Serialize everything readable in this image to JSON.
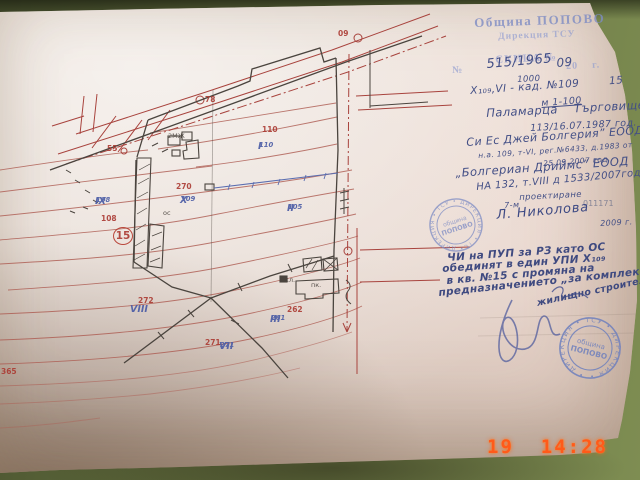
{
  "camera_timestamp": "19  14:28",
  "document": {
    "round_stamp": {
      "center_line1": "община",
      "center_line2": "ПОПОВО",
      "ring_text": "• ДИРЕКЦИЯ • ТСУ • ДИРЕКЦИЯ • ТСУ"
    }
  },
  "hw": {
    "lines": [
      {
        "n": "office-stamp-line1",
        "t": "Община ПОПОВО",
        "x": 474,
        "y": 16,
        "s": 13,
        "r": -2,
        "c": "stamp"
      },
      {
        "n": "office-stamp-line2",
        "t": "Дирекция ТСУ",
        "x": 498,
        "y": 33,
        "s": 9.5,
        "r": -2,
        "c": "stamp2"
      },
      {
        "n": "sketch-title",
        "t": "СКИЦА №",
        "x": 495,
        "y": 55,
        "s": 11,
        "r": -2.5,
        "c": "stamp2"
      },
      {
        "n": "form-number-sign",
        "t": "№",
        "x": 452,
        "y": 66,
        "s": 10,
        "r": -2.5,
        "c": "stamp2"
      },
      {
        "n": "form-year",
        "t": "20    г.",
        "x": 566,
        "y": 62,
        "s": 10,
        "r": -2.5,
        "c": "stamp2"
      },
      {
        "n": "sketch-number",
        "t": "515/1965",
        "x": 486,
        "y": 58,
        "s": 13,
        "r": -5,
        "c": "ink"
      },
      {
        "n": "sketch-year",
        "t": "09",
        "x": 556,
        "y": 57,
        "s": 12,
        "r": -5,
        "c": "ink"
      },
      {
        "n": "area-value",
        "t": "1000",
        "x": 517,
        "y": 76,
        "s": 8.5,
        "r": -3,
        "c": "ink"
      },
      {
        "n": "parcel-line",
        "t": "Х₁₀₉,VI - кад. №109        15",
        "x": 470,
        "y": 86,
        "s": 10.5,
        "r": -4,
        "c": "ink"
      },
      {
        "n": "scale-note",
        "t": "м 1-100",
        "x": 541,
        "y": 99,
        "s": 9.5,
        "r": -4,
        "c": "ink underl"
      },
      {
        "n": "place-line",
        "t": "Паламарца    Търговище",
        "x": 486,
        "y": 108,
        "s": 11.5,
        "r": -3,
        "c": "ink"
      },
      {
        "n": "ref-number",
        "t": "113/16.07.1987 год.",
        "x": 530,
        "y": 124,
        "s": 9.5,
        "r": -3,
        "c": "ink"
      },
      {
        "n": "owner1",
        "t": "Си Ес Джей Болгерия” ЕООД",
        "x": 466,
        "y": 137,
        "s": 11,
        "r": -4,
        "c": "ink"
      },
      {
        "n": "deed1",
        "t": "н.а. 109, т-VI, рег.№6433, д.1983 от",
        "x": 478,
        "y": 152,
        "s": 7.5,
        "r": -4,
        "c": "ink"
      },
      {
        "n": "deed1-date",
        "t": "25.09.2007 год.",
        "x": 543,
        "y": 160,
        "s": 7.5,
        "r": -4,
        "c": "ink"
      },
      {
        "n": "owner2",
        "t": "„Болгериан Дриймс” ЕООД",
        "x": 455,
        "y": 168,
        "s": 11.5,
        "r": -4,
        "c": "ink"
      },
      {
        "n": "deed2",
        "t": "НА 132, т.VIII д 1533/2007год.",
        "x": 476,
        "y": 183,
        "s": 10,
        "r": -5,
        "c": "ink"
      },
      {
        "n": "purpose",
        "t": "проектиране",
        "x": 519,
        "y": 194,
        "s": 8.5,
        "r": -3,
        "c": "ink"
      },
      {
        "n": "sig-prefix",
        "t": "7-м",
        "x": 504,
        "y": 202,
        "s": 8,
        "r": -3,
        "c": "ink"
      },
      {
        "n": "code-number",
        "t": "011171",
        "x": 583,
        "y": 200,
        "s": 8,
        "r": 0,
        "c": "inkfaint"
      },
      {
        "n": "officer-name",
        "t": "Л. Николова",
        "x": 496,
        "y": 209,
        "s": 13,
        "r": -5,
        "c": "inksig"
      },
      {
        "n": "year2",
        "t": "2009 г.",
        "x": 600,
        "y": 220,
        "s": 8,
        "r": -3,
        "c": "ink"
      },
      {
        "n": "note-line1",
        "t": "ЧИ на ПУП за РЗ като ОС",
        "x": 447,
        "y": 253,
        "s": 10.5,
        "r": -4,
        "c": "note"
      },
      {
        "n": "note-line2",
        "t": "обединят в един УПИ Х₁₀₉",
        "x": 442,
        "y": 264,
        "s": 10.5,
        "r": -4,
        "c": "note"
      },
      {
        "n": "note-line3",
        "t": "в кв. №15 с промяна на",
        "x": 446,
        "y": 276,
        "s": 10.5,
        "r": -5,
        "c": "note"
      },
      {
        "n": "note-line4",
        "t": "предназначението „за комплексно",
        "x": 438,
        "y": 288,
        "s": 10.5,
        "r": -6,
        "c": "note"
      },
      {
        "n": "note-line5",
        "t": "жилищно строителство”",
        "x": 536,
        "y": 299,
        "s": 9.5,
        "r": -12,
        "c": "note"
      }
    ]
  },
  "map": {
    "parcel_labels": [
      {
        "roman": "IX",
        "num": "108",
        "x": 95,
        "y": 197
      },
      {
        "roman": "X",
        "num": "109",
        "x": 180,
        "y": 196
      },
      {
        "roman": "I",
        "num": "110",
        "x": 258,
        "y": 142
      },
      {
        "roman": "II",
        "num": "105",
        "x": 287,
        "y": 204
      },
      {
        "roman": "III",
        "num": "261",
        "x": 270,
        "y": 315
      },
      {
        "roman": "VIII",
        "num": "",
        "x": 130,
        "y": 305
      },
      {
        "roman": "VII",
        "num": "271",
        "x": 219,
        "y": 342
      }
    ],
    "red_numbers": [
      {
        "t": "110",
        "x": 262,
        "y": 126
      },
      {
        "t": "270",
        "x": 176,
        "y": 183
      },
      {
        "t": "108",
        "x": 101,
        "y": 215
      },
      {
        "t": "272",
        "x": 138,
        "y": 297
      },
      {
        "t": "262",
        "x": 287,
        "y": 306
      },
      {
        "t": "271",
        "x": 205,
        "y": 339
      },
      {
        "t": "365",
        "x": 1,
        "y": 368
      },
      {
        "t": "55",
        "x": 107,
        "y": 145
      },
      {
        "t": "78",
        "x": 205,
        "y": 96
      },
      {
        "t": "09",
        "x": 338,
        "y": 30
      },
      {
        "t": "15",
        "x": 113,
        "y": 227,
        "circled": true
      }
    ],
    "black_labels": [
      {
        "t": "ос",
        "x": 163,
        "y": 210
      },
      {
        "t": "жл.",
        "x": 283,
        "y": 277
      },
      {
        "t": "пк.",
        "x": 311,
        "y": 282
      },
      {
        "t": "2МЖ",
        "x": 168,
        "y": 133
      }
    ]
  }
}
